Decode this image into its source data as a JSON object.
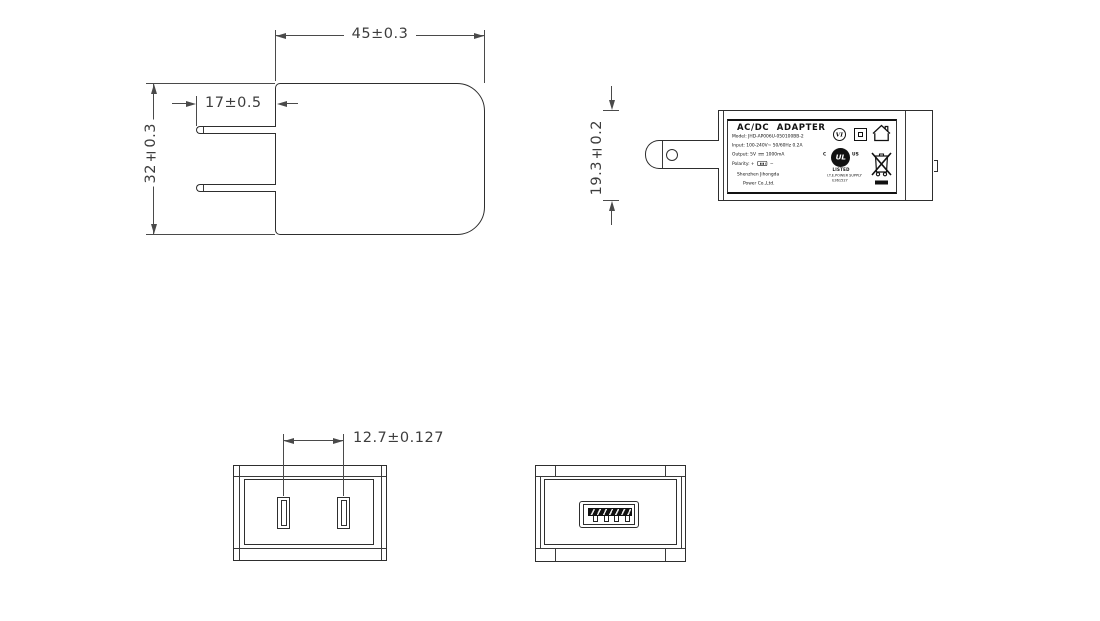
{
  "colors": {
    "line": "#2e2e2e",
    "dim": "#4a4a4a",
    "text": "#3d3d3d",
    "black": "#111111",
    "bg": "#ffffff"
  },
  "dims": {
    "body_width": "45±0.3",
    "body_height": "32±0.3",
    "pin_length": "17±0.5",
    "body_thickness": "19.3±0.2",
    "pin_pitch": "12.7±0.127"
  },
  "label": {
    "title": "AC/DC ADAPTER",
    "model": "Model: JHD-AP006U-050100BB-2",
    "input": "Input: 100-240V~ 50/60Hz 0.2A",
    "output_prefix": "Output: 5V",
    "output_suffix": "1000mA",
    "polarity": "Polarity:",
    "plus": "+",
    "minus": "−",
    "company_line1": "Shenzhen Jihongda",
    "company_line2": "Power Co.,Ltd.",
    "efficiency": "VI",
    "ul_c": "C",
    "ul_mark": "UL",
    "ul_us": "US",
    "ul_listed": "LISTED",
    "ul_type": "I.T.E.POWER SUPPLY",
    "ul_file": "E361527"
  }
}
